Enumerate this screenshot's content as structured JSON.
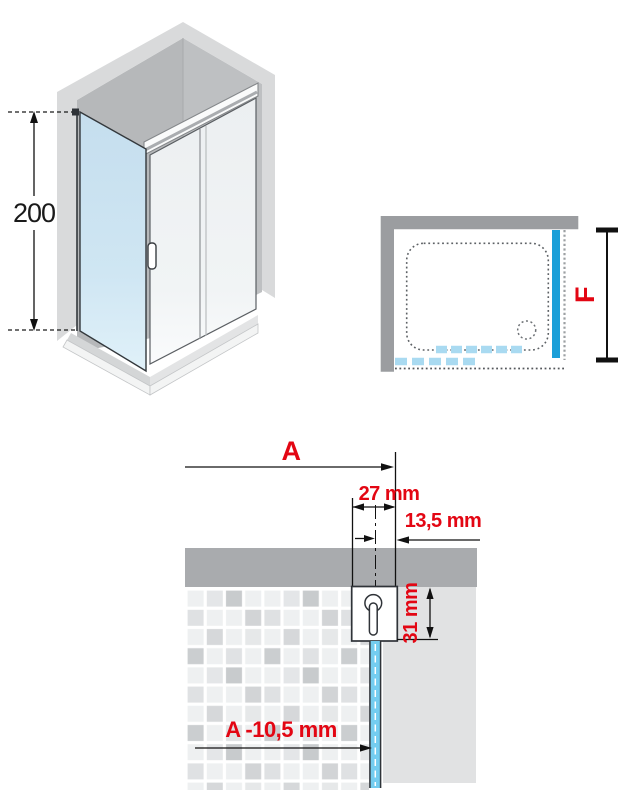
{
  "colors": {
    "red": "#e30613",
    "blue": "#1b9fd8",
    "blue_dash": "#a9daf1",
    "glass_blue": "#74cdf0",
    "wall_gray": "#9b9da0",
    "band_gray": "#a9abae",
    "interior_gray": "#e1e2e3"
  },
  "iso_view": {
    "height_dim": "200"
  },
  "plan_view": {
    "depth_dim": "F"
  },
  "detail_view": {
    "width_dim": "A",
    "profile_width_dim": "27 mm",
    "offset_dim": "13,5 mm",
    "profile_depth_dim": "31 mm",
    "glass_width_dim": "A -10,5 mm"
  }
}
